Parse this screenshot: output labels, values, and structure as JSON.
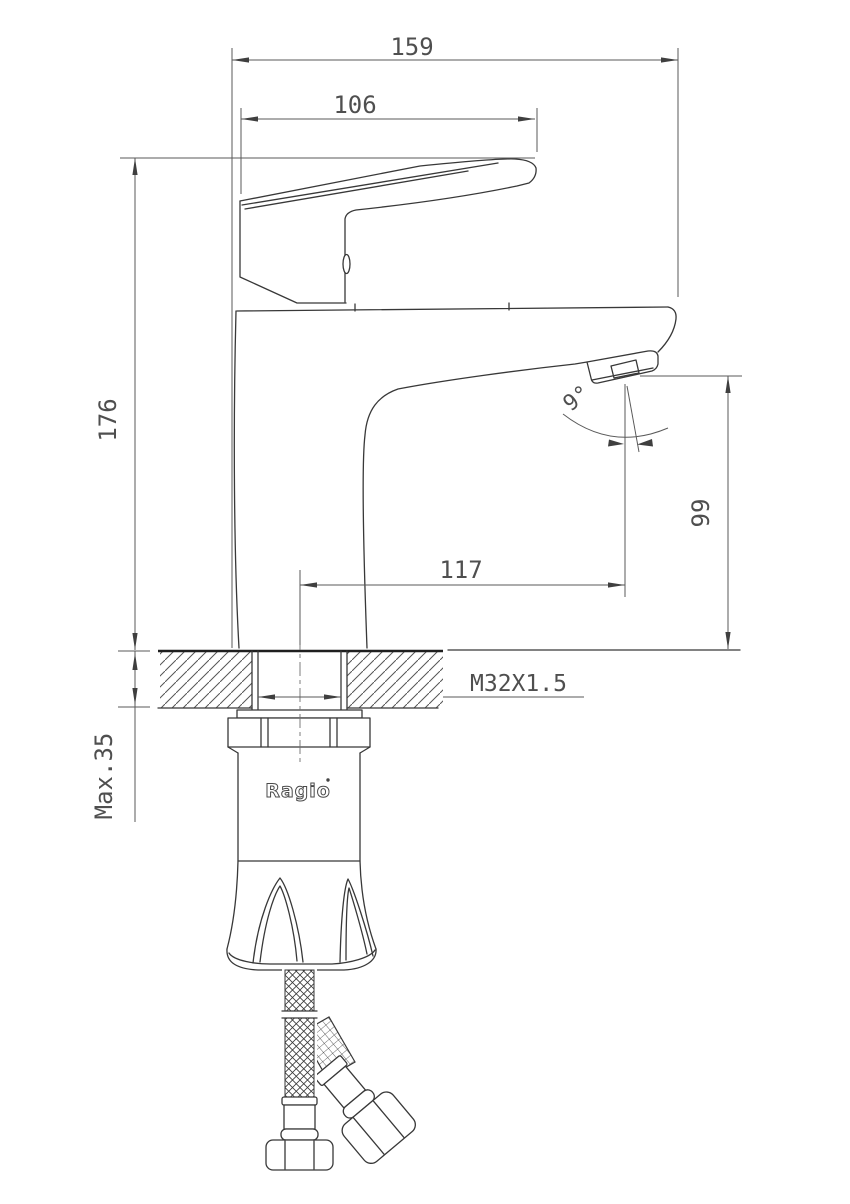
{
  "drawing": {
    "type": "faucet technical dimension drawing",
    "brand": "Ragio",
    "labels": {
      "overall_length": "159",
      "handle_length": "106",
      "total_height": "176",
      "spout_reach": "117",
      "spout_height": "99",
      "spout_angle": "9°",
      "thread_size": "M32X1.5",
      "max_thickness": "Max.35"
    }
  }
}
